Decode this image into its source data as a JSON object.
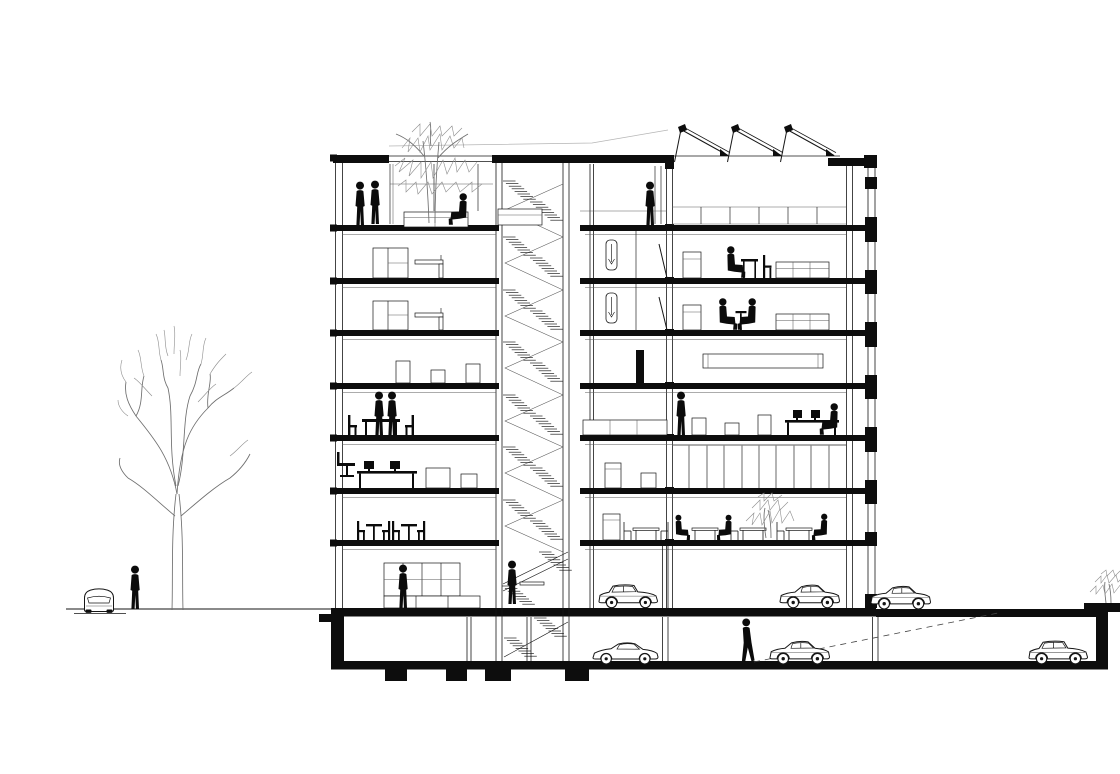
{
  "meta": {
    "title": "Building cross-section — architectural drawing",
    "description": "Black-and-white sectional elevation of an eight-storey building with a central stair core, sawtooth roof with three north-light skylights, roof terrace with planted tree and glass pavilion, furnished apartment and office floors, a cafe level with an indoor plant, ground-level parking and a basement garage with cars, a pedestrian and a dashed exit ramp; at street level a bare deciduous tree, a parked car seen front-on and a pedestrian; at right a parked sedan and a shrub in a planter over the buried garage."
  },
  "palette": {
    "background": "#ffffff",
    "ink": "#161616",
    "cut_fill": "#0d0d0d",
    "silhouette": "#0b0b0b",
    "sketch_gray": "#6e6e6e",
    "faint_gray": "#b5b5b5"
  },
  "building": {
    "stories_above_ground": 8,
    "basement_levels": 1,
    "roof": {
      "left": "roof terrace with glass pavilion, planter and tree",
      "right": "sawtooth roof, 3 skylights",
      "skylight_count": 3
    },
    "core": {
      "type": "central stair core",
      "flights_per_storey": 2
    },
    "floors_top_to_bottom": [
      {
        "name": "roof-terrace",
        "contents": [
          "glass pavilion",
          "tree in planter",
          "two people talking",
          "seated person"
        ]
      },
      {
        "name": "sawtooth-hall",
        "contents": [
          "clerestory glazing band",
          "person standing at window"
        ]
      },
      {
        "name": "apartment-upper",
        "contents": [
          "wardrobe",
          "counter",
          "shower room",
          "person at dining table",
          "sofa"
        ]
      },
      {
        "name": "apartment-lower",
        "contents": [
          "wardrobe",
          "counter",
          "shower room",
          "two people at table",
          "sofa"
        ]
      },
      {
        "name": "storage-floor",
        "contents": [
          "crates",
          "long workbench outline"
        ]
      },
      {
        "name": "meeting-floor",
        "contents": [
          "two people standing at table",
          "chairs",
          "office desk with monitors",
          "copier",
          "boxes",
          "seated worker"
        ]
      },
      {
        "name": "workstation-floor",
        "contents": [
          "office chair",
          "desk with two monitors",
          "boxes",
          "curtain-wall band"
        ]
      },
      {
        "name": "cafe-floor",
        "contents": [
          "bistro tables",
          "chairs",
          "three seated guests",
          "indoor plant",
          "fridge"
        ]
      },
      {
        "name": "ground-floor",
        "contents": [
          "showroom with glazed shelving and person",
          "parking bay with two cars"
        ]
      },
      {
        "name": "basement-garage",
        "contents": [
          "three cars",
          "walking person",
          "dashed exit ramp",
          "pad footings"
        ]
      }
    ],
    "parking": {
      "ground_cars": 2,
      "basement_cars": 3,
      "outdoor_cars": 2,
      "ramp": "dashed line rising to grade at right"
    }
  },
  "entourage": {
    "people_total": 18,
    "cars_total": 7,
    "street_left": {
      "tree": "bare deciduous tree",
      "car": "front-view parked car",
      "pedestrians": 1
    },
    "site_right": {
      "parked_sedan": 1,
      "shrub_in_planter": 1
    }
  }
}
